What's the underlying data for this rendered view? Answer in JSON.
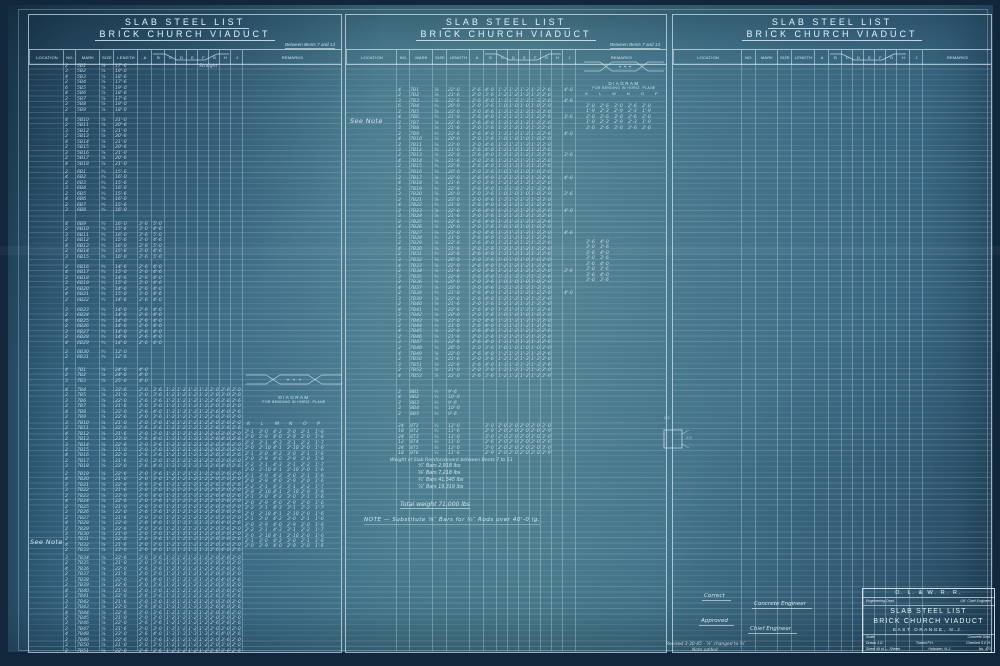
{
  "titles": {
    "line1": "SLAB STEEL LIST",
    "line2": "BRICK CHURCH VIADUCT",
    "between": "Between Bents 7 and 13"
  },
  "columns": [
    "LOCATION",
    "NO.",
    "MARK",
    "SIZE",
    "LENGTH",
    "A",
    "B",
    "C",
    "D",
    "E",
    "F",
    "G",
    "H",
    "J",
    "REMARKS"
  ],
  "diagram": {
    "title": "DIAGRAM",
    "sub": "FOR BENDING IN HORIZ. PLANE",
    "letters": "K L M N O P"
  },
  "notes": {
    "see_note": "See Note",
    "main_note": "NOTE — Substitute ⅞″ Bars for ¾″ Rods over 40'-0 lg."
  },
  "weights": {
    "heading": "Weight of Slab Reinforcement between Bents 7 to 13",
    "lines": [
      "½″ Bars    2,918  lbs",
      "⅝″ Bars    7,218  lbs",
      "¾″ Bars   41,545  lbs",
      "⅞″ Bars   19,319  lbs"
    ],
    "total": "Total weight 71,000 lbs"
  },
  "square": {
    "top": "2'-0",
    "side": "2'-0"
  },
  "signatures": {
    "correct": "Correct",
    "concrete": "Concrete Engineer",
    "approved": "Approved",
    "chief": "Chief Engineer"
  },
  "revision": {
    "line1": "Revised 3-30-45 - ⅞″ changed to ¾″",
    "line2": "Note added"
  },
  "title_block": {
    "railroad": "D. L. & W. R. R.",
    "dept": "Engineering Dept.",
    "office": "Off. Chief Engineer",
    "line1": "SLAB STEEL LIST",
    "line2": "BRICK CHURCH VIADUCT",
    "location": "EAST ORANGE, N.J.",
    "scale": "Scale",
    "concrete_dept": "Concrete Dept.",
    "drawn": "Drawn J.G.",
    "traced": "Traced F.H.",
    "checked": "Checked S.E.H.",
    "sheet": "Sheet 49 of — Sheets",
    "office_loc": "Hoboken, N.J.",
    "number": "No. 471"
  },
  "tables": {
    "left": {
      "groups": [
        {
          "top": 2,
          "rows": [
            "|2|5B1|⅞|17'-6||||||Straight",
            "|3|5B2|⅞|19'-0",
            "|4|5B3|⅞|18'-6",
            "|2|5B4|⅞|17'-6",
            "|6|5B5|⅞|19'-0",
            "|4|5B6|⅞|18'-6",
            "|2|5B7|⅞|17'-6",
            "|3|5B8|⅞|19'-0",
            "|2|5B9|⅞|18'-0"
          ]
        },
        {
          "top": 56,
          "rows": [
            "|4|5B10|⅞|21'-0",
            "|2|5B11|⅞|20'-6",
            "|3|5B12|⅞|21'-0",
            "|2|5B13|⅞|20'-6",
            "|4|5B14|⅞|21'-0",
            "|2|5B15|⅞|20'-6",
            "|3|5B16|⅞|21'-0",
            "|2|5B17|⅞|20'-6",
            "|4|5B18|⅞|21'-0"
          ]
        },
        {
          "top": 108,
          "rows": [
            "|2|6B1|¾|15'-6",
            "|4|6B2|¾|16'-0",
            "|2|6B3|¾|15'-6",
            "|3|6B4|¾|16'-0",
            "|2|6B5|¾|15'-6",
            "|4|6B6|¾|16'-0",
            "|2|6B7|¾|15'-6",
            "|3|6B8|¾|16'-0"
          ]
        },
        {
          "top": 160,
          "rows": [
            "|4|6B9|¾|16'-0|3'-6|5'-0",
            "|2|6B10|¾|15'-6|3'-0|4'-6",
            "|3|6B11|¾|16'-0|3'-6|5'-0",
            "|2|6B12|¾|15'-6|3'-0|4'-6",
            "|4|6B13|¾|16'-0|3'-6|5'-0",
            "|2|6B14|¾|15'-6|3'-0|4'-6",
            "|3|6B15|¾|16'-0|3'-6|5'-0"
          ]
        },
        {
          "top": 203,
          "rows": [
            "|2|6B16|¾|14'-6|2'-6|4'-0",
            "|4|6B17|¾|15'-0|3'-0|4'-6",
            "|2|6B18|¾|14'-6|2'-6|4'-0",
            "|3|6B19|¾|15'-0|3'-0|4'-6",
            "|2|6B20|¾|14'-6|2'-6|4'-0",
            "|4|6B21|¾|15'-0|3'-0|4'-6",
            "|2|6B22|¾|14'-6|2'-6|4'-0"
          ]
        },
        {
          "top": 246,
          "rows": [
            "|3|6B23|¾|14'-0|2'-6|4'-0",
            "|2|6B24|¾|14'-6|2'-6|4'-0",
            "|4|6B25|¾|14'-0|2'-6|4'-0",
            "|2|6B26|¾|14'-6|2'-6|4'-0",
            "|3|6B27|¾|14'-0|2'-6|4'-0",
            "|2|6B28|¾|14'-6|2'-6|4'-0",
            "|4|6B29|¾|14'-0|2'-6|4'-0"
          ]
        },
        {
          "top": 288,
          "rows": [
            "|2|6B30|¾|12'-0",
            "|2|6B31|¾|12'-6"
          ]
        },
        {
          "top": 306,
          "rows": [
            "|4|7B1|⅞|24'-0|4'-0",
            "|2|7B2|⅞|24'-6|4'-0",
            "|3|7B3|⅞|25'-0|4'-0"
          ]
        },
        {
          "top": 326,
          "rows": [
            "|4|7B4|⅞|22'-6|2'-0|3'-6|1'-2|1'-2|1'-2|1'-2|2'-0|3'-6|2'-0",
            "|2|7B5|⅞|21'-0|2'-0|3'-0|1'-2|1'-2|1'-2|1'-2|2'-0|3'-0|2'-0",
            "|3|7B6|⅞|22'-0|2'-6|3'-6|1'-2|1'-2|1'-2|1'-2|2'-6|3'-6|2'-6",
            "|2|7B7|⅞|21'-6|2'-0|3'-0|1'-2|1'-2|1'-2|1'-2|2'-0|3'-0|2'-0",
            "|4|7B8|⅞|23'-0|2'-6|4'-0|1'-3|1'-3|1'-3|1'-3|2'-6|4'-0|2'-6",
            "|2|7B9|⅞|22'-6|2'-0|3'-6|1'-2|1'-2|1'-2|1'-2|2'-0|3'-6|2'-0",
            "|3|7B10|⅞|21'-0|2'-0|3'-0|1'-2|1'-2|1'-2|1'-2|2'-0|3'-0|2'-0",
            "|2|7B11|⅞|22'-0|2'-6|3'-6|1'-2|1'-2|1'-2|1'-2|2'-6|3'-6|2'-6",
            "|4|7B12|⅞|21'-6|2'-0|3'-0|1'-2|1'-2|1'-2|1'-2|2'-0|3'-0|2'-0",
            "|2|7B13|⅞|23'-0|2'-6|4'-0|1'-3|1'-3|1'-3|1'-3|2'-6|4'-0|2'-6",
            "|3|7B14|⅞|22'-6|2'-0|3'-6|1'-2|1'-2|1'-2|1'-2|2'-0|3'-6|2'-0",
            "|2|7B15|⅞|21'-0|2'-0|3'-0|1'-2|1'-2|1'-2|1'-2|2'-0|3'-0|2'-0",
            "|4|7B16|⅞|22'-0|2'-6|3'-6|1'-2|1'-2|1'-2|1'-2|2'-6|3'-6|2'-6",
            "|2|7B17|⅞|21'-6|2'-0|3'-0|1'-2|1'-2|1'-2|1'-2|2'-0|3'-0|2'-0",
            "|3|7B18|⅞|23'-0|2'-6|4'-0|1'-3|1'-3|1'-3|1'-3|2'-6|4'-0|2'-6"
          ]
        },
        {
          "top": 410,
          "rows": [
            "|2|7B19|⅞|22'-6|2'-0|3'-6|1'-2|1'-2|1'-2|1'-2|2'-0|3'-6|2'-0",
            "|4|7B20|⅞|21'-0|2'-0|3'-0|1'-2|1'-2|1'-2|1'-2|2'-0|3'-0|2'-0",
            "|2|7B21|⅞|22'-0|2'-6|3'-6|1'-2|1'-2|1'-2|1'-2|2'-6|3'-6|2'-6",
            "|3|7B22|⅞|21'-6|2'-0|3'-0|1'-2|1'-2|1'-2|1'-2|2'-0|3'-0|2'-0",
            "|2|7B23|⅞|23'-0|2'-6|4'-0|1'-3|1'-3|1'-3|1'-3|2'-6|4'-0|2'-6",
            "|4|7B24|⅞|22'-6|2'-0|3'-6|1'-2|1'-2|1'-2|1'-2|2'-0|3'-6|2'-0",
            "|2|7B25|⅞|21'-0|2'-0|3'-0|1'-2|1'-2|1'-2|1'-2|2'-0|3'-0|2'-0",
            "|3|7B26|⅞|22'-0|2'-6|3'-6|1'-2|1'-2|1'-2|1'-2|2'-6|3'-6|2'-6",
            "|2|7B27|⅞|21'-6|2'-0|3'-0|1'-2|1'-2|1'-2|1'-2|2'-0|3'-0|2'-0",
            "|4|7B28|⅞|23'-0|2'-6|4'-0|1'-3|1'-3|1'-3|1'-3|2'-6|4'-0|2'-6",
            "|2|7B29|⅞|22'-6|2'-0|3'-6|1'-2|1'-2|1'-2|1'-2|2'-0|3'-6|2'-0",
            "|3|7B30|⅞|21'-0|2'-0|3'-0|1'-2|1'-2|1'-2|1'-2|2'-0|3'-0|2'-0",
            "|2|7B31|⅞|22'-0|2'-6|3'-6|1'-2|1'-2|1'-2|1'-2|2'-6|3'-6|2'-6",
            "|4|7B32|⅞|21'-6|2'-0|3'-0|1'-2|1'-2|1'-2|1'-2|2'-0|3'-0|2'-0",
            "|2|7B33|⅞|23'-0|2'-6|4'-0|1'-3|1'-3|1'-3|1'-3|2'-6|4'-0|2'-6"
          ]
        },
        {
          "top": 494,
          "rows": [
            "|3|7B34|⅞|22'-6|2'-0|3'-6|1'-2|1'-2|1'-2|1'-2|2'-0|3'-6|2'-0",
            "|2|7B35|⅞|21'-0|2'-0|3'-0|1'-2|1'-2|1'-2|1'-2|2'-0|3'-0|2'-0",
            "|4|7B36|⅞|22'-0|2'-6|3'-6|1'-2|1'-2|1'-2|1'-2|2'-6|3'-6|2'-6",
            "|2|7B37|⅞|21'-6|2'-0|3'-0|1'-2|1'-2|1'-2|1'-2|2'-0|3'-0|2'-0",
            "|3|7B38|⅞|23'-0|2'-6|4'-0|1'-3|1'-3|1'-3|1'-3|2'-6|4'-0|2'-6",
            "|2|7B39|⅞|22'-6|2'-0|3'-6|1'-2|1'-2|1'-2|1'-2|2'-0|3'-6|2'-0",
            "|4|7B40|⅞|21'-0|2'-0|3'-0|1'-2|1'-2|1'-2|1'-2|2'-0|3'-0|2'-0",
            "|2|7B41|⅞|22'-0|2'-6|3'-6|1'-2|1'-2|1'-2|1'-2|2'-6|3'-6|2'-6",
            "|3|7B42|⅞|21'-6|2'-0|3'-0|1'-2|1'-2|1'-2|1'-2|2'-0|3'-0|2'-0",
            "|2|7B43|⅞|23'-0|2'-6|4'-0|1'-3|1'-3|1'-3|1'-3|2'-6|4'-0|2'-6",
            "|4|7B44|⅞|22'-6|2'-0|3'-6|1'-2|1'-2|1'-2|1'-2|2'-0|3'-6|2'-0",
            "|2|7B45|⅞|21'-0|2'-0|3'-0|1'-2|1'-2|1'-2|1'-2|2'-0|3'-0|2'-0",
            "|3|7B46|⅞|22'-0|2'-6|3'-6|1'-2|1'-2|1'-2|1'-2|2'-6|3'-6|2'-6",
            "|2|7B47|⅞|21'-6|2'-0|3'-0|1'-2|1'-2|1'-2|1'-2|2'-0|3'-0|2'-0",
            "|4|7B48|⅞|23'-0|2'-6|4'-0|1'-3|1'-3|1'-3|1'-3|2'-6|4'-0|2'-6",
            "|2|7B49|⅞|22'-6|2'-0|3'-6|1'-2|1'-2|1'-2|1'-2|2'-0|3'-6|2'-0",
            "|3|7B50|⅞|21'-0|2'-0|3'-0|1'-2|1'-2|1'-2|1'-2|2'-0|3'-0|2'-0",
            "|2|7B51|⅞|22'-0|2'-6|3'-6|1'-2|1'-2|1'-2|1'-2|2'-6|3'-6|2'-6"
          ]
        }
      ],
      "sub_letters": [
        {
          "top": 360,
          "rows": [
            "K|L|M|N|O|P"
          ]
        }
      ],
      "sub": [
        {
          "top": 368,
          "rows": [
            "2'-1|3'-0|4'-2|3'-0|2'-1|1'-6",
            "2'-0|2'-9|4'-0|2'-9|2'-0|1'-6",
            "2'-2|3'-1|4'-3|3'-1|2'-2|1'-7",
            "2'-0|2'-10|4'-1|2'-10|2'-0|1'-6",
            "2'-1|3'-0|4'-2|3'-0|2'-1|1'-6",
            "2'-0|2'-9|4'-0|2'-9|2'-0|1'-6",
            "2'-2|3'-1|4'-3|3'-1|2'-2|1'-7",
            "2'-0|2'-10|4'-1|2'-10|2'-0|1'-6",
            "2'-1|3'-0|4'-2|3'-0|2'-1|1'-6",
            "2'-0|2'-9|4'-0|2'-9|2'-0|1'-6",
            "2'-2|3'-1|4'-3|3'-1|2'-2|1'-7",
            "2'-0|2'-10|4'-1|2'-10|2'-0|1'-6",
            "2'-1|3'-0|4'-2|3'-0|2'-1|1'-6",
            "2'-0|2'-9|4'-0|2'-9|2'-0|1'-6",
            "2'-2|3'-1|4'-3|3'-1|2'-2|1'-7",
            "2'-0|2'-10|4'-1|2'-10|2'-0|1'-6",
            "2'-1|3'-0|4'-2|3'-0|2'-1|1'-6",
            "2'-0|2'-9|4'-0|2'-9|2'-0|1'-6",
            "2'-2|3'-1|4'-3|3'-1|2'-2|1'-7",
            "2'-0|2'-10|4'-1|2'-10|2'-0|1'-6",
            "2'-1|3'-0|4'-2|3'-0|2'-1|1'-6",
            "2'-0|2'-9|4'-0|2'-9|2'-0|1'-6"
          ]
        }
      ]
    },
    "middle": {
      "groups": [
        {
          "top": 26,
          "rows": [
            "|4|7B1|⅞|22'-0|2'-6|4'-0|1'-2|1'-2|1'-2|1'-2|2'-6||4'-0",
            "|2|7B2|⅞|21'-6|2'-0|3'-6|1'-2|1'-2|1'-2|1'-2|2'-0",
            "|3|7B3|⅞|22'-6|2'-6|4'-0|1'-3|1'-3|1'-3|1'-3|2'-6||4'-6",
            "|6|7B4|¾|20'-0|2'-0|3'-6|1'-0|1'-0|1'-0|1'-0|2'-0",
            "|2|7B5|⅞|23'-0|3'-0|4'-6|1'-3|1'-3|1'-3|1'-3|3'-0",
            "|4|7B6|¾|21'-0|2'-6|4'-0|1'-2|1'-2|1'-2|1'-2|2'-6||3'-6",
            "|2|7B7|⅞|22'-0|2'-6|4'-0|1'-2|1'-2|1'-2|1'-2|2'-6",
            "|3|7B8|⅞|21'-6|2'-0|3'-6|1'-2|1'-2|1'-2|1'-2|2'-0",
            "|2|7B9|¾|22'-6|2'-6|4'-0|1'-3|1'-3|1'-3|1'-3|2'-6||4'-0",
            "|4|7B10|⅞|20'-0|2'-0|3'-6|1'-0|1'-0|1'-0|1'-0|2'-0",
            "|2|7B11|⅞|23'-0|3'-0|4'-6|1'-3|1'-3|1'-3|1'-3|3'-0",
            "|3|7B12|¾|21'-0|2'-6|4'-0|1'-2|1'-2|1'-2|1'-2|2'-6",
            "|2|7B13|⅞|22'-0|2'-6|4'-0|1'-2|1'-2|1'-2|1'-2|2'-6||3'-6",
            "|4|7B14|⅞|21'-6|2'-0|3'-6|1'-2|1'-2|1'-2|1'-2|2'-0",
            "|2|7B15|¾|22'-6|2'-6|4'-0|1'-3|1'-3|1'-3|1'-3|2'-6",
            "|3|7B16|⅞|20'-0|2'-0|3'-6|1'-0|1'-0|1'-0|1'-0|2'-0"
          ]
        },
        {
          "top": 114,
          "rows": [
            "|2|7B17|⅞|22'-0|2'-6|4'-0|1'-2|1'-2|1'-2|1'-2|2'-6||4'-0",
            "|4|7B18|⅞|21'-6|2'-0|3'-6|1'-2|1'-2|1'-2|1'-2|2'-0",
            "|2|7B19|¾|22'-6|2'-6|4'-0|1'-3|1'-3|1'-3|1'-3|2'-6",
            "|3|7B20|⅞|20'-0|2'-0|3'-6|1'-0|1'-0|1'-0|1'-0|2'-0||3'-6",
            "|2|7B21|⅞|23'-0|3'-0|4'-6|1'-3|1'-3|1'-3|1'-3|3'-0",
            "|4|7B22|¾|21'-0|2'-6|4'-0|1'-2|1'-2|1'-2|1'-2|2'-6",
            "|2|7B23|⅞|22'-0|2'-6|4'-0|1'-2|1'-2|1'-2|1'-2|2'-6||4'-0",
            "|3|7B24|⅞|21'-6|2'-0|3'-6|1'-2|1'-2|1'-2|1'-2|2'-0",
            "|2|7B25|¾|22'-6|2'-6|4'-0|1'-3|1'-3|1'-3|1'-3|2'-6",
            "|4|7B26|⅞|20'-0|2'-0|3'-6|1'-0|1'-0|1'-0|1'-0|2'-0",
            "|2|7B27|⅞|23'-0|3'-0|4'-6|1'-3|1'-3|1'-3|1'-3|3'-0||4'-6",
            "|3|7B28|¾|21'-0|2'-6|4'-0|1'-2|1'-2|1'-2|1'-2|2'-6",
            "|2|7B29|⅞|22'-0|2'-6|4'-0|1'-2|1'-2|1'-2|1'-2|2'-6",
            "|4|7B30|⅞|21'-6|2'-0|3'-6|1'-2|1'-2|1'-2|1'-2|2'-0",
            "|2|7B31|¾|22'-6|2'-6|4'-0|1'-3|1'-3|1'-3|1'-3|2'-6",
            "|3|7B32|⅞|20'-0|2'-0|3'-6|1'-0|1'-0|1'-0|1'-0|2'-0"
          ]
        },
        {
          "top": 202,
          "rows": [
            "|4|7B33|⅞|22'-0|2'-6|4'-0|1'-2|1'-2|1'-2|1'-2|2'-6",
            "|2|7B34|⅞|21'-6|2'-0|3'-6|1'-2|1'-2|1'-2|1'-2|2'-0||3'-6",
            "|3|7B35|¾|22'-6|2'-6|4'-0|1'-3|1'-3|1'-3|1'-3|2'-6",
            "|2|7B36|⅞|20'-0|2'-0|3'-6|1'-0|1'-0|1'-0|1'-0|2'-0",
            "|4|7B37|⅞|23'-0|3'-0|4'-6|1'-3|1'-3|1'-3|1'-3|3'-0",
            "|2|7B38|¾|21'-0|2'-6|4'-0|1'-2|1'-2|1'-2|1'-2|2'-6||4'-0",
            "|3|7B39|⅞|22'-0|2'-6|4'-0|1'-2|1'-2|1'-2|1'-2|2'-6",
            "|2|7B40|⅞|21'-6|2'-0|3'-6|1'-2|1'-2|1'-2|1'-2|2'-0",
            "|4|7B41|¾|22'-6|2'-6|4'-0|1'-3|1'-3|1'-3|1'-3|2'-6",
            "|2|7B42|⅞|20'-0|2'-0|3'-6|1'-0|1'-0|1'-0|1'-0|2'-0",
            "|3|7B43|⅞|23'-0|3'-0|4'-6|1'-3|1'-3|1'-3|1'-3|3'-0",
            "|2|7B44|¾|21'-0|2'-6|4'-0|1'-2|1'-2|1'-2|1'-2|2'-6",
            "|4|7B45|⅞|22'-0|2'-6|4'-0|1'-2|1'-2|1'-2|1'-2|2'-6",
            "|2|7B46|⅞|21'-6|2'-0|3'-6|1'-2|1'-2|1'-2|1'-2|2'-0",
            "|3|7B47|¾|22'-6|2'-6|4'-0|1'-3|1'-3|1'-3|1'-3|2'-6",
            "|2|7B48|⅞|20'-0|2'-0|3'-6|1'-0|1'-0|1'-0|1'-0|2'-0"
          ]
        },
        {
          "top": 290,
          "rows": [
            "|4|7B49|⅞|22'-0|2'-6|4'-0|1'-2|1'-2|1'-2|1'-2|2'-6",
            "|2|7B50|⅞|21'-6|2'-0|3'-6|1'-2|1'-2|1'-2|1'-2|2'-0",
            "|3|7B51|⅞|22'-6|2'-6|4'-0|1'-3|1'-3|1'-3|1'-3|2'-6",
            "|2|7B52|⅞|21'-0|2'-0|3'-0|1'-2|1'-2|1'-2|1'-2|2'-0",
            "|4|7B53|⅞|22'-0|2'-6|3'-6|1'-2|1'-2|1'-2|1'-2|2'-6"
          ]
        },
        {
          "top": 328,
          "rows": [
            "|2|8B1|½|9'-6",
            "|4|8B2|½|10'-0",
            "|2|8B3|½|9'-6",
            "|3|8B4|½|10'-0",
            "|2|8B5|½|9'-6"
          ]
        },
        {
          "top": 362,
          "rows": [
            "|24|8T1|½|12'-0||3'-0|2'-0|2'-0|2'-0|2'-0|3'-0",
            "|18|8T2|½|11'-6||2'-9|2'-0|2'-0|2'-0|2'-0|2'-9",
            "|24|8T3|½|12'-0||3'-0|2'-0|2'-0|2'-0|2'-0|3'-0",
            "|12|8T4|½|11'-0||2'-6|2'-0|2'-0|2'-0|2'-0|2'-6",
            "|24|8T5|½|12'-0||3'-0|2'-0|2'-0|2'-0|2'-0|3'-0",
            "|18|8T6|½|11'-6||2'-9|2'-0|2'-0|2'-0|2'-0|2'-9"
          ]
        }
      ],
      "rem1": [
        {
          "top": 42,
          "rows": [
            "2'-0|2'-6|3'-0|2'-6|2'-0",
            "1'-9|2'-3|2'-9|2'-3|1'-9",
            "2'-0|2'-6|3'-0|2'-6|2'-0",
            "1'-9|2'-3|2'-9|2'-3|1'-9",
            "2'-0|2'-6|3'-0|2'-6|2'-0"
          ]
        }
      ],
      "rem2": [
        {
          "top": 178,
          "rows": [
            "3'-6|4'-0",
            "3'-0|3'-6",
            "3'-6|4'-0",
            "3'-0|3'-6",
            "3'-6|4'-0",
            "3'-0|3'-6",
            "3'-6|4'-0",
            "3'-0|3'-6"
          ]
        }
      ]
    }
  }
}
